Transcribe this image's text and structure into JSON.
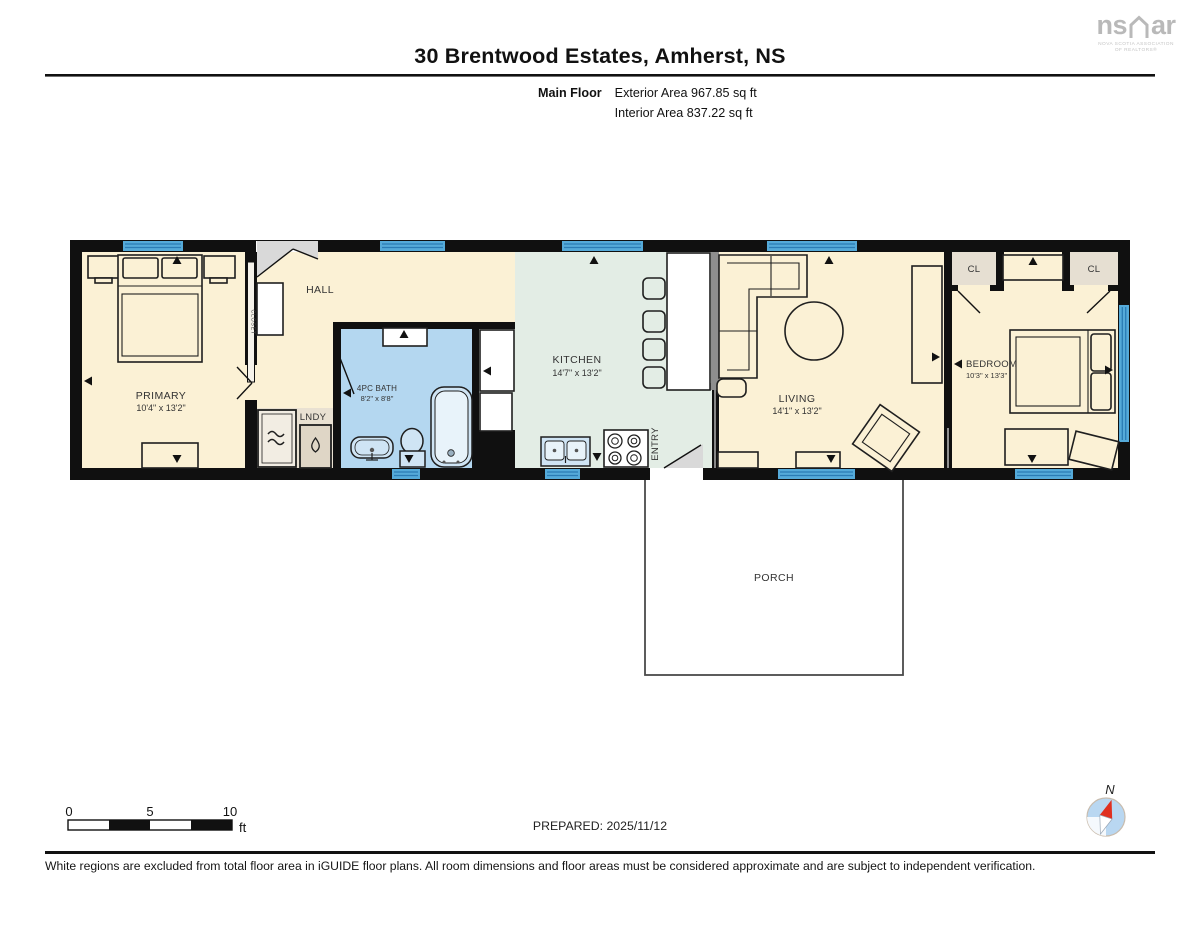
{
  "header": {
    "title": "30 Brentwood Estates, Amherst, NS",
    "floor_label": "Main Floor",
    "exterior_area": "Exterior Area 967.85 sq ft",
    "interior_area": "Interior Area 837.22 sq ft"
  },
  "logo": {
    "prefix": "ns",
    "suffix": "ar",
    "tagline_line1": "NOVA SCOTIA ASSOCIATION",
    "tagline_line2": "OF REALTORS®"
  },
  "plan": {
    "rooms": {
      "primary": {
        "name": "PRIMARY",
        "dims": "10'4\" x 13'2\""
      },
      "hall": {
        "name": "HALL"
      },
      "bath": {
        "name": "4PC BATH",
        "dims": "8'2\" x 8'8\""
      },
      "laundry": {
        "name": "LNDY"
      },
      "kitchen": {
        "name": "KITCHEN",
        "dims": "14'7\" x 13'2\""
      },
      "entry": {
        "name": "ENTRY"
      },
      "living": {
        "name": "LIVING",
        "dims": "14'1\" x 13'2\""
      },
      "bedroom": {
        "name": "BEDROOM",
        "dims": "10'3\" x 13'3\""
      },
      "porch": {
        "name": "PORCH"
      },
      "closet_left": {
        "name": "CL"
      },
      "closet_right": {
        "name": "CL"
      },
      "closet_primary": {
        "name": "CLOSET"
      }
    },
    "colors": {
      "room_cream": "#FBF1D5",
      "room_mint": "#E3EDE5",
      "room_bath_blue": "#B4D7F0",
      "room_tan": "#E9E1D2",
      "window_blue": "#55AAD9",
      "wall_black": "#101010",
      "half_wall_gray": "#8E8E8E"
    }
  },
  "scale_bar": {
    "tick0": "0",
    "tick5": "5",
    "tick10": "10",
    "unit": "ft"
  },
  "prepared": "PREPARED: 2025/11/12",
  "compass_label": "N",
  "footer": {
    "disclaimer": "White regions are excluded from total floor area in iGUIDE floor plans. All room dimensions and floor areas must be considered approximate and are subject to independent verification."
  }
}
